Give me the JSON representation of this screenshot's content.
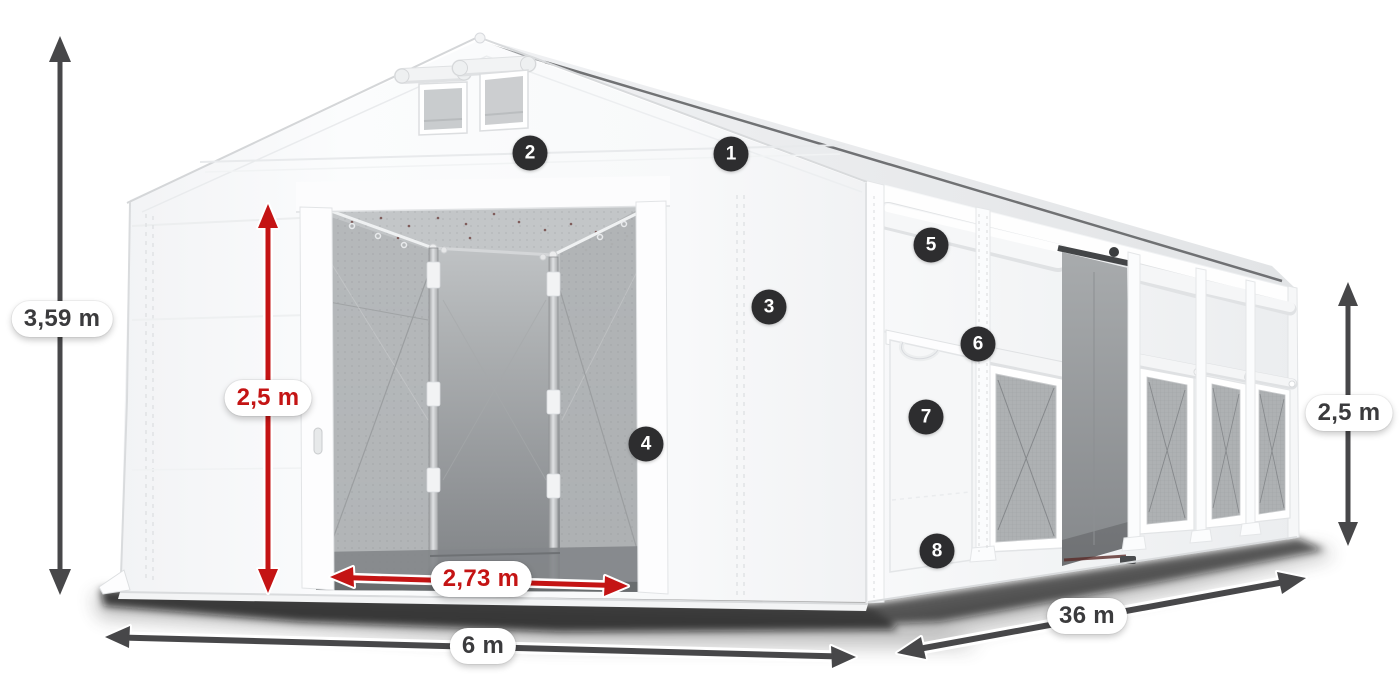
{
  "diagram": {
    "title": "Tent dimension diagram",
    "subject": "White modular storage tent shown as 3D render with numbered features and dimension arrows",
    "background": "#ffffff"
  },
  "dimensions": {
    "total_height": {
      "label": "3,59 m",
      "style": "dark"
    },
    "door_height": {
      "label": "2,5 m",
      "style": "red"
    },
    "door_width": {
      "label": "2,73 m",
      "style": "red"
    },
    "tent_width": {
      "label": "6 m",
      "style": "dark"
    },
    "tent_length": {
      "label": "36 m",
      "style": "dark"
    },
    "side_height": {
      "label": "2,5 m",
      "style": "dark"
    }
  },
  "markers": [
    {
      "label": "1"
    },
    {
      "label": "2"
    },
    {
      "label": "3"
    },
    {
      "label": "4"
    },
    {
      "label": "5"
    },
    {
      "label": "6"
    },
    {
      "label": "7"
    },
    {
      "label": "8"
    }
  ],
  "colors": {
    "dimension_dark": "#474749",
    "dimension_red": "#c41414",
    "marker_background": "#2d2d2f",
    "marker_text": "#ffffff",
    "label_pill_background": "#ffffff",
    "label_text_dark": "#3b3b3d",
    "tent_white": "#f7f8fa",
    "interior_gray": "#9b9ea1"
  }
}
